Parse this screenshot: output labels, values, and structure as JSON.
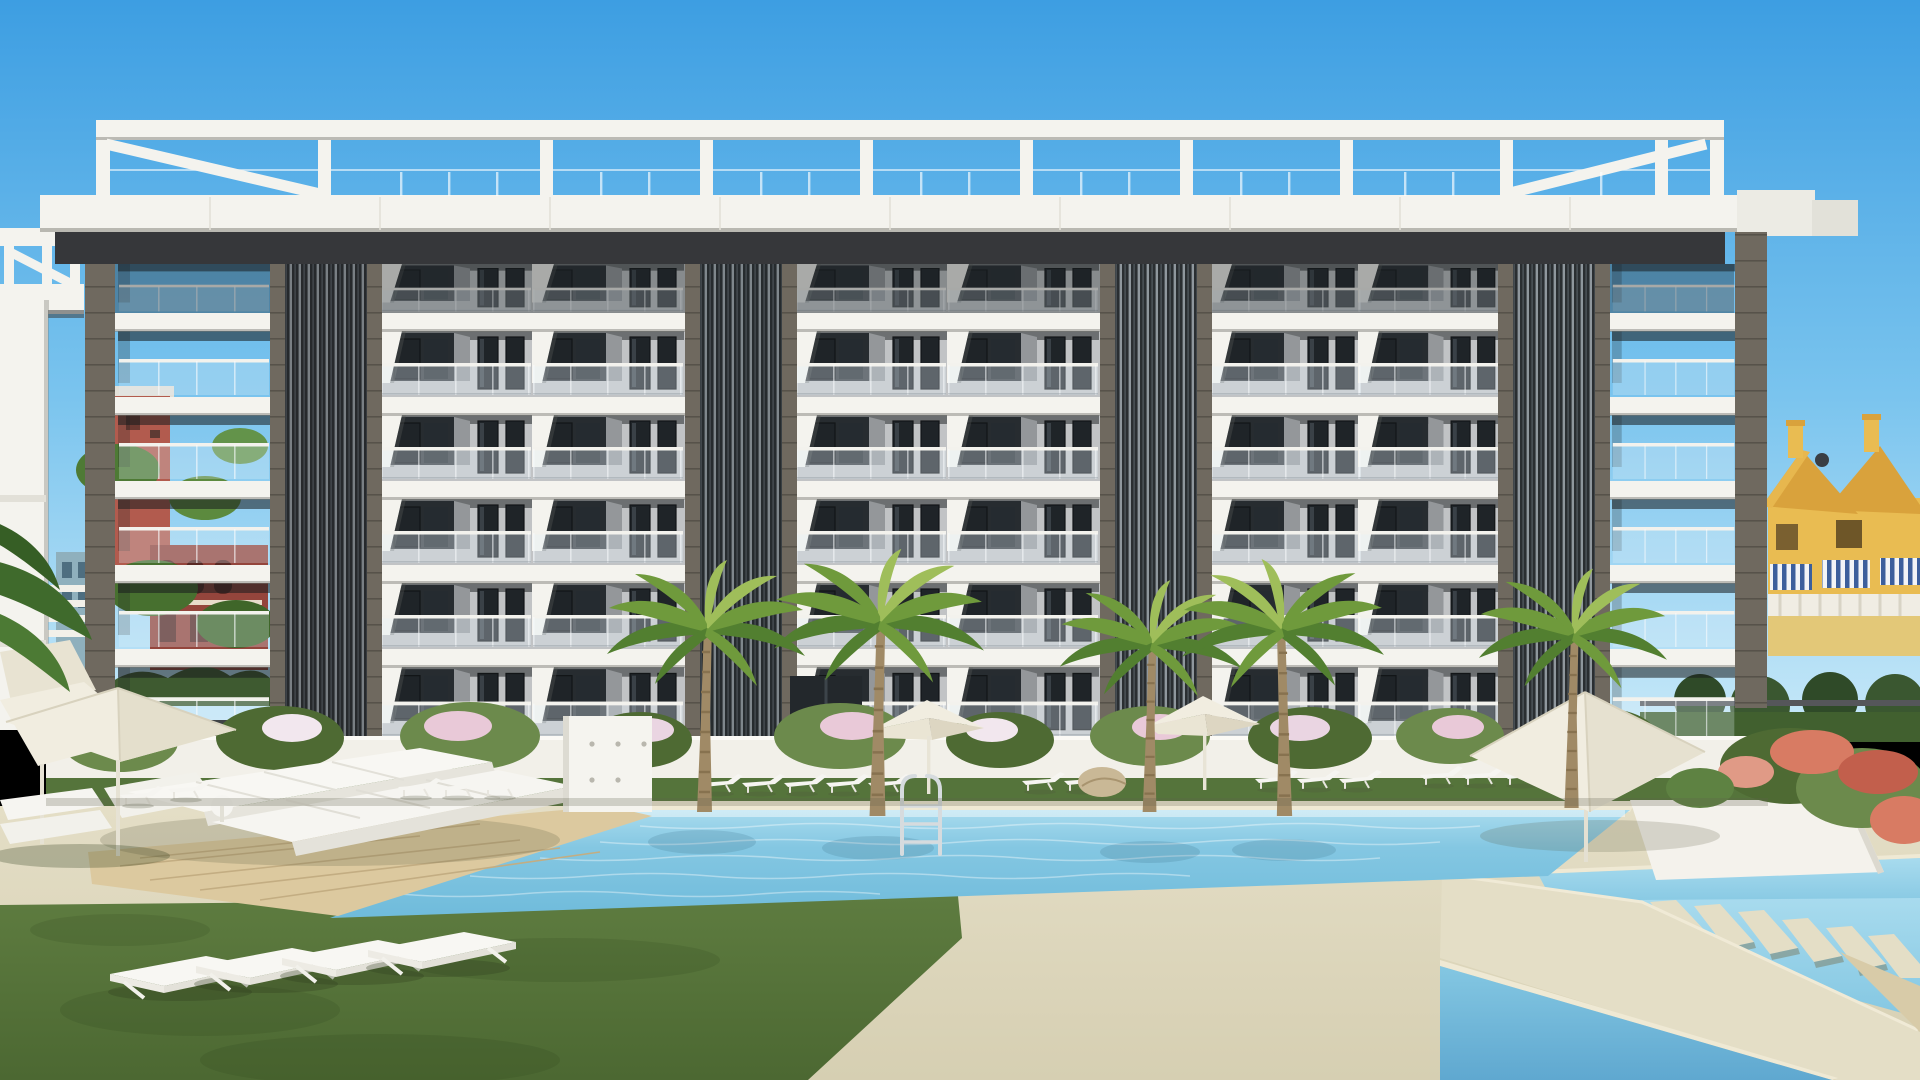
{
  "meta": {
    "scene_type": "architectural-3d-render",
    "description": "New-build residential complex render: white six-storey apartment building with rooftop pergola, dark vertical louvre cores, glass balconies; communal garden with main swimming pool, secondary pool with stepping stones, wooden deck with daybeds, sun loungers, parasols, palm trees and lawn under a clear blue sky.",
    "image_text": []
  },
  "palette": {
    "sky-top": "#3D9EE2",
    "sky-mid": "#7AC4EE",
    "sky-low": "#C4E7F8",
    "white": "#F4F3EE",
    "white-shade": "#E2E0D8",
    "soffit": "#36373A",
    "wall-gray": "#C1C3C5",
    "wall-gray-dark": "#94979A",
    "recess": "#272C30",
    "window": "#1F2428",
    "frame": "#121517",
    "glass": "rgba(226,240,248,0.32)",
    "rail": "#F3F2ED",
    "louvre-dark": "#2A2E31",
    "louvre-light": "#8F979D",
    "tower-border": "#6F695F",
    "tower-joint": "#57524A",
    "garden-wall": "#F2F0E9",
    "shrub": "#6C8A4C",
    "shrub-dark": "#4E6A33",
    "flower-pink": "#E9C9D8",
    "flower-coral": "#D87B63",
    "water-1": "#84C7E2",
    "water-2": "#6FBBDB",
    "water-3": "#A8DBEE",
    "water-deep": "#5FA8D0",
    "coping": "#EFE9D4",
    "paving": "#E4DEC6",
    "paving-dark": "#D6CFB2",
    "deck": "#DCC99F",
    "deck-line": "#C3AD82",
    "grass": "#5E7C40",
    "grass-dark": "#4C6832",
    "leaf": "#6F9A3C",
    "leaf-dark": "#527F30",
    "leaf-bright": "#9FBE5A",
    "trunk": "#A08A66",
    "trunk-dark": "#87724F",
    "bg-red": "#B25B4E",
    "bg-red-dark": "#94453C",
    "bg-teal": "#8FB0BD",
    "house-yellow": "#E9BC52",
    "house-roof": "#D9A23C",
    "awning-blue": "#3C5F9C",
    "metal": "#D6DBDE",
    "cream": "#F1EDE0",
    "cream-shade": "#DDD6C2"
  },
  "scene": {
    "sky": {
      "condition": "clear",
      "gradient": [
        "sky-top",
        "sky-mid",
        "sky-low"
      ]
    },
    "main_building": {
      "storeys": 6,
      "rooftop_pergola": true,
      "pergola_posts": 11,
      "pergola_diagonal_braces": 2,
      "louvre_towers": 4,
      "corner_columns": 2,
      "bays_per_floor": 8,
      "balustrade": "frameless glass with handrail",
      "materials": [
        "white concrete slabs",
        "grey textured panels",
        "dark aluminium louvres",
        "taupe brick piers"
      ]
    },
    "neighbor_building_left": {
      "visible": true,
      "style": "same white complex, cropped at left edge",
      "rooftop_pergola": true
    },
    "background_left": {
      "buildings": [
        "terracotta block with balconies",
        "dark red arched block",
        "teal-grey block"
      ],
      "palm_trees": 4
    },
    "background_right": {
      "townhouses": "yellow with ochre gable roofs",
      "chimneys": 2,
      "satellite_dish": 1,
      "striped_awnings": 3,
      "hedge_and_trees": true
    },
    "pool_area": {
      "main_pool": {
        "shape": "long parallelogram",
        "ladder": 1
      },
      "second_pool": {
        "stepping_stones": 6,
        "diagonal_walkway": true,
        "triangle_kids_pool": true
      },
      "wooden_deck": {
        "daybeds": 2
      },
      "lawn_sunbeds": 4,
      "lounger_row_count": 16,
      "umbrellas_total": 6,
      "outdoor_shower_wall": 1,
      "garden_wall_with_flowers": true,
      "front_palm_trees": 5
    }
  }
}
